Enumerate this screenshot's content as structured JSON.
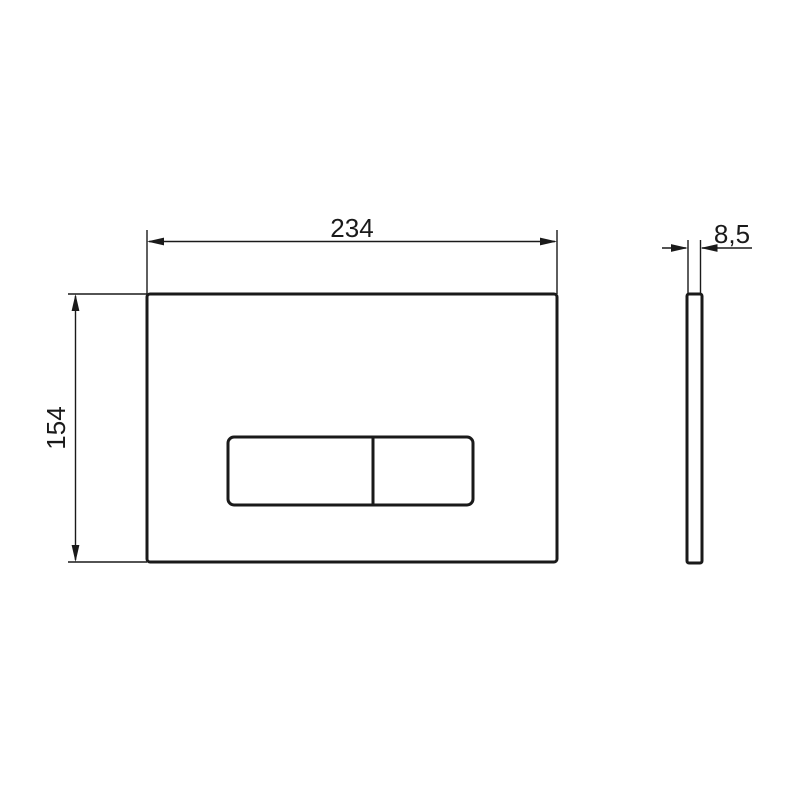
{
  "colors": {
    "line": "#1a1a1a",
    "background": "#ffffff"
  },
  "front_view": {
    "width_dimension_label": "234",
    "height_dimension_label": "154"
  },
  "side_view": {
    "thickness_dimension_label": "8,5"
  }
}
